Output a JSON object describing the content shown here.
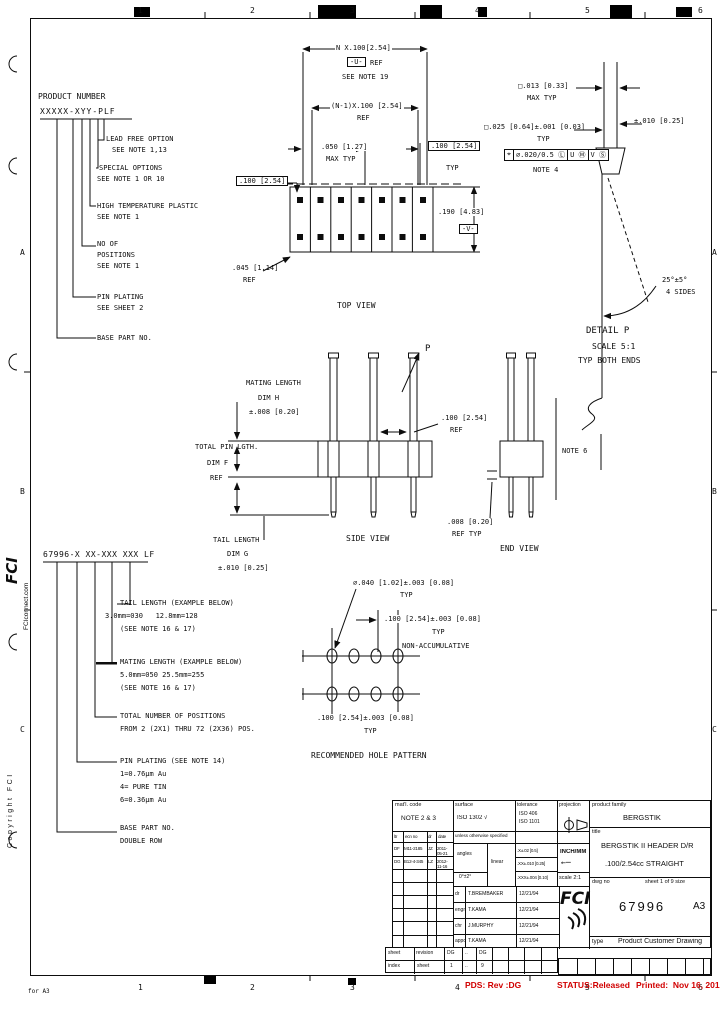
{
  "border": {
    "top_numbers": [
      "1",
      "2",
      "3",
      "4",
      "5",
      "6"
    ],
    "bottom_numbers": [
      "1",
      "2",
      "3",
      "4",
      "5",
      "6"
    ],
    "left_letters": [
      "A",
      "B",
      "C"
    ],
    "right_letters": [
      "A",
      "B",
      "C"
    ],
    "corner_note": "for A3"
  },
  "margin": {
    "logo": "FCI",
    "website": "FCIconnect.com",
    "copyright": "Copyright FCI"
  },
  "product_number": {
    "title": "PRODUCT NUMBER",
    "code": "XXXXX-XYY-PLF",
    "callouts": [
      {
        "l1": "LEAD FREE OPTION",
        "l2": "SEE NOTE 1,13"
      },
      {
        "l1": "SPECIAL OPTIONS",
        "l2": "SEE NOTE 1 OR 10"
      },
      {
        "l1": "HIGH TEMPERATURE PLASTIC",
        "l2": "SEE NOTE 1"
      },
      {
        "l1": "NO OF",
        "l2": "POSITIONS",
        "l3": "SEE NOTE 1"
      },
      {
        "l1": "PIN PLATING",
        "l2": "SEE SHEET 2"
      },
      {
        "l1": "BASE PART NO."
      }
    ]
  },
  "top_view": {
    "dim_n": "N X.100[2.54]",
    "datum_u": "-U-",
    "datum_u_ref": "REF",
    "see_note_19": "SEE NOTE 19",
    "dim_n1": "(N-1)X.100 [2.54]",
    "dim_n1_ref": "REF",
    "dim_050": ".050 [1.27]",
    "dim_050_sub": "MAX TYP",
    "dim_100_right": ".100 [2.54]",
    "dim_100_right_sub": "TYP",
    "dim_100_left": ".100 [2.54]",
    "dim_190": ".190 [4.83]",
    "datum_v": "-V-",
    "dim_045": ".045 [1.14]",
    "dim_045_sub": "REF",
    "label": "TOP VIEW"
  },
  "pin_detail": {
    "dim_013": "□.013 [0.33]",
    "dim_013_sub": "MAX TYP",
    "dim_025": "□.025 [0.64]±.001 [0.03]",
    "dim_025_sub": "TYP",
    "fcf": {
      "f1": "⌖",
      "f2": "∅.020/0.5 Ⓛ",
      "f3": "U Ⓜ",
      "f4": "V Ⓢ"
    },
    "fcf_note": "NOTE 4",
    "dim_010": "±.010 [0.25]",
    "angle": "25°±5°",
    "angle_sub": "4 SIDES",
    "label": "DETAIL P",
    "scale": "SCALE 5:1",
    "typ": "TYP BOTH ENDS"
  },
  "side_view": {
    "mating1": "MATING LENGTH",
    "mating2": "DIM H",
    "mating3": "±.008 [0.20]",
    "total1": "TOTAL PIN LGTH.",
    "total2": "DIM F",
    "total3": "REF",
    "tail1": "TAIL LENGTH",
    "tail2": "DIM G",
    "tail3": "±.010 [0.25]",
    "dim_100": ".100 [2.54]",
    "dim_100_sub": "REF",
    "p_label": "P",
    "label": "SIDE VIEW"
  },
  "end_view": {
    "note6": "NOTE 6",
    "dim_008": ".008 [0.20]",
    "dim_008_sub": "REF TYP",
    "label": "END VIEW"
  },
  "hole_pattern": {
    "dia": "∅.040 [1.02]±.003 [0.08]",
    "dia_sub": "TYP",
    "pitch_h": ".100 [2.54]±.003 [0.08]",
    "pitch_h_sub": "TYP",
    "pitch_h_note": "NON-ACCUMULATIVE",
    "pitch_v": ".100 [2.54]±.003 [0.08]",
    "pitch_v_sub": "TYP",
    "label": "RECOMMENDED HOLE PATTERN"
  },
  "part_number": {
    "code": "67996-X XX-XXX XXX LF",
    "tail1": "TAIL LENGTH (EXAMPLE BELOW)",
    "tail2": "3.0mm=030   12.8mm=128",
    "tail3": "(SEE NOTE 16 & 17)",
    "mating1": "MATING LENGTH (EXAMPLE BELOW)",
    "mating2": "5.0mm=050 25.5mm=255",
    "mating3": "(SEE NOTE 16 & 17)",
    "pos1": "TOTAL NUMBER OF POSITIONS",
    "pos2": "FROM 2 (2X1) THRU 72 (2X36) POS.",
    "plat1": "PIN PLATING (SEE NOTE 14)",
    "plat2": "1=0.76μm Au",
    "plat3": "4= PURE TIN",
    "plat4": "6=0.36μm Au",
    "base1": "BASE PART NO.",
    "base2": "DOUBLE ROW"
  },
  "title_block": {
    "matl_label": "mat'l. code",
    "matl_note": "NOTE 2 & 3",
    "ecn": {
      "headers": [
        "ltr",
        "ecn no",
        "dr",
        "date"
      ],
      "rows": [
        [
          "DF",
          "M11-2185",
          "JZ",
          "2011-05-21"
        ],
        [
          "DG",
          "B12-4-345",
          "LZ",
          "2012-11-16"
        ]
      ]
    },
    "surface_label": "surface",
    "surface_value": "ISO 1302 √",
    "tol_label": "tolerance",
    "tol_v1": "ISO 406",
    "tol_v2": "ISO 1101",
    "proj_label": "projection",
    "unless": "unless otherwise specified",
    "angles_label": "angles",
    "angles_value": "0°±2°",
    "linear_label": "linear",
    "linear_rows": [
      ".X±.02 [0.5]",
      ".XX±.010 [0.25]",
      ".XXX±.004 [0.10]"
    ],
    "units": "INCH/MM",
    "scale": "scale 2:1",
    "signoff": [
      {
        "role": "dr",
        "name": "T.BREMBAKER",
        "date": "12/21/94"
      },
      {
        "role": "engr",
        "name": "T.KAMA",
        "date": "12/21/94"
      },
      {
        "role": "chr",
        "name": "J.MURPHY",
        "date": "12/21/94"
      },
      {
        "role": "appd",
        "name": "T.KAMA",
        "date": "12/21/94"
      }
    ],
    "family_label": "product family",
    "family": "BERGSTIK",
    "title_label": "title",
    "title1": "BERGSTIK II HEADER D/R",
    "title2": ".100/2.54cc STRAIGHT",
    "dwg_label": "dwg no",
    "sheet_label": "sheet 1 of 9 size",
    "dwg_no": "67996",
    "size": "A3",
    "type_label": "type",
    "type_value": "Product Customer Drawing",
    "logo": "FCI",
    "index": {
      "row_label_1": "sheet",
      "row_label_2": "index",
      "rev_label": "revision",
      "sheet_row_label": "sheet",
      "rev_cells": [
        "DG",
        "..",
        "DG"
      ],
      "sheet_cells": [
        "1",
        "..",
        "9"
      ]
    }
  },
  "footer": {
    "pds": "PDS: Rev :DG",
    "status": "STATUS:Released",
    "printed": "Printed:  Nov 16, 2012"
  }
}
